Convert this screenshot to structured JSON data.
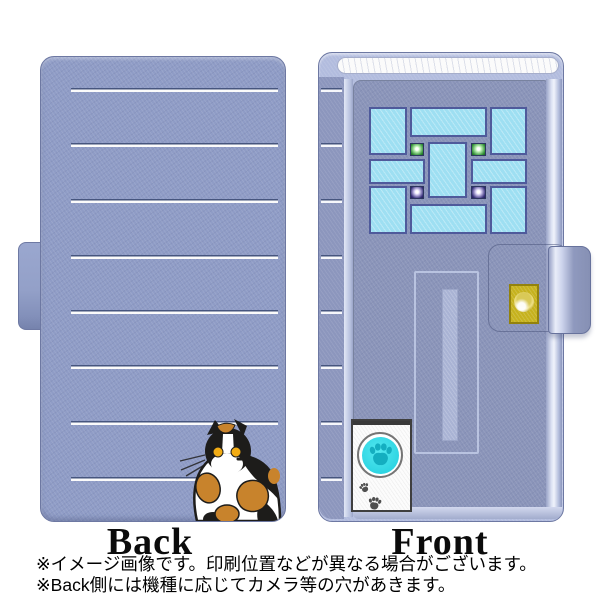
{
  "page": {
    "back_label": "Back",
    "front_label": "Front",
    "footnotes": [
      "※イメージ画像です。印刷位置などが異なる場合がございます。",
      "※Back側には機種に応じてカメラ等の穴があきます。"
    ]
  },
  "icons": {
    "doorbell_button": "paw-print-icon",
    "footprints": "paw-prints-icon",
    "snap_button": "gold-knob-icon"
  },
  "colors": {
    "case_base": "#8f9cc6",
    "case_frame_light": "#b2bcde",
    "door_panel": "#8a94b9",
    "stripe_navy": "#46557e",
    "stripe_white": "#fbfbfb",
    "window_pane_cyan": "#9edff2",
    "pane_border": "#4f5a9b",
    "lamp_green": "#2f8c35",
    "lamp_purple": "#37307a",
    "gold_plate": "#c6b21d",
    "doorbell_cyan": "#2cd4e2",
    "paw_teal": "#14aec0",
    "cat_black": "#1d1c1a",
    "cat_orange": "#c8832c",
    "cat_eye_yellow": "#f2ac14",
    "background": "#ffffff"
  }
}
